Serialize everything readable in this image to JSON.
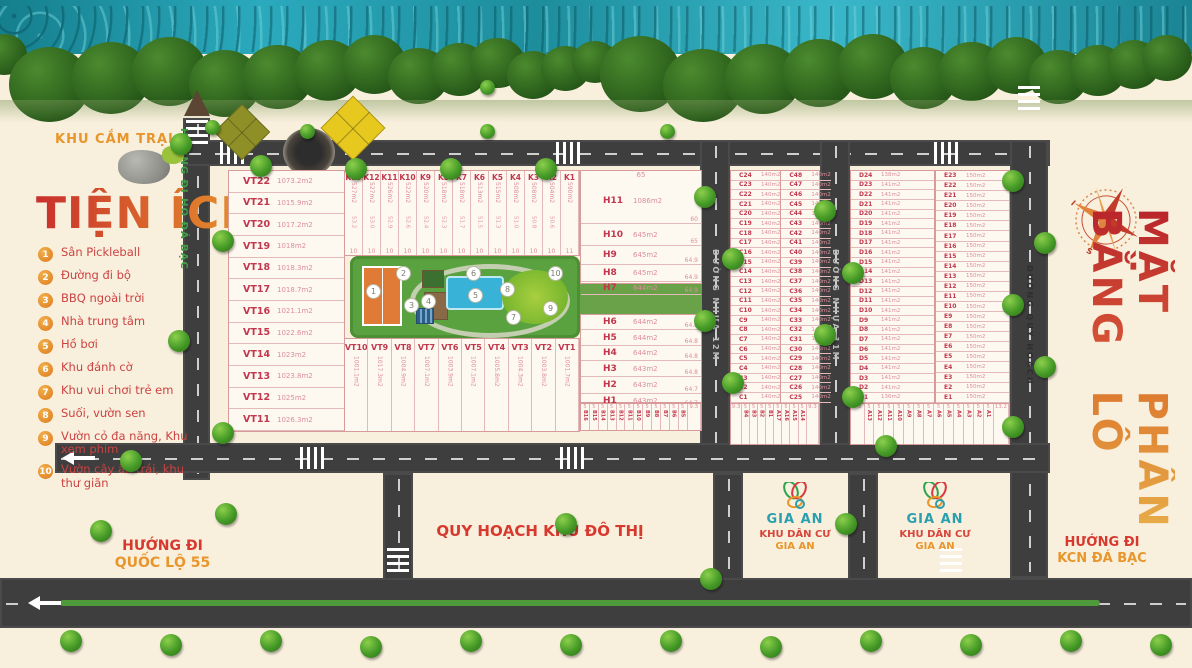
{
  "title": {
    "line1": "MẶT BẰNG",
    "line2": "PHÂN LÔ"
  },
  "compass": {
    "n": "N",
    "e": "E",
    "s": "S",
    "w": "W"
  },
  "legend": {
    "zone_label_red": "KHU CẮM",
    "zone_label_orange": "TRẠI",
    "title": "TIỆN ÍCH",
    "items": [
      {
        "num": "1",
        "label": "Sân Pickleball"
      },
      {
        "num": "2",
        "label": "Đường đi bộ"
      },
      {
        "num": "3",
        "label": "BBQ ngoài trời"
      },
      {
        "num": "4",
        "label": "Nhà trung tâm"
      },
      {
        "num": "5",
        "label": "Hồ bơi"
      },
      {
        "num": "6",
        "label": "Khu đánh cờ"
      },
      {
        "num": "7",
        "label": "Khu vui chơi trẻ em"
      },
      {
        "num": "8",
        "label": "Suối, vườn sen"
      },
      {
        "num": "9",
        "label": "Vườn cỏ đa năng, Khu xem phim"
      },
      {
        "num": "10",
        "label": "Vườn cây ăn trái, khu thư giãn"
      }
    ]
  },
  "roads": {
    "left_vertical": "HƯỚNG ĐI HỒ ĐÁ BẠC",
    "nhua12": "ĐƯỜNG NHỰA 12M",
    "nhua11": "ĐƯỜNG NHỰA 11M",
    "quyhoach": "ĐƯỜNG QUY HOẠCH",
    "bottom_center": "QUY HOẠCH KHU ĐÔ THỊ",
    "bottom_left_1": "HƯỚNG ĐI",
    "bottom_left_2": "QUỐC LỘ 55",
    "bottom_right_1": "HƯỚNG ĐI",
    "bottom_right_2": "KCN ĐÁ BẠC"
  },
  "gia_an": {
    "logo_text": "GIA AN",
    "line1": "KHU DÂN CƯ",
    "line2": "GIA AN"
  },
  "blocks": {
    "vt_left": [
      {
        "id": "VT22",
        "area": "1073.2m2"
      },
      {
        "id": "VT21",
        "area": "1015.9m2"
      },
      {
        "id": "VT20",
        "area": "1017.2m2"
      },
      {
        "id": "VT19",
        "area": "1018m2"
      },
      {
        "id": "VT18",
        "area": "1018.3m2"
      },
      {
        "id": "VT17",
        "area": "1018.7m2"
      },
      {
        "id": "VT16",
        "area": "1021.1m2"
      },
      {
        "id": "VT15",
        "area": "1022.6m2"
      },
      {
        "id": "VT14",
        "area": "1023m2"
      },
      {
        "id": "VT13",
        "area": "1023.8m2"
      },
      {
        "id": "VT12",
        "area": "1025m2"
      },
      {
        "id": "VT11",
        "area": "1026.3m2"
      }
    ],
    "k_row": [
      {
        "id": "K13",
        "area": "527m2",
        "dim": "53.2",
        "w": "10"
      },
      {
        "id": "K12",
        "area": "527m2",
        "dim": "53.0",
        "w": "10"
      },
      {
        "id": "K11",
        "area": "526m2",
        "dim": "52.9",
        "w": "10"
      },
      {
        "id": "K10",
        "area": "522m2",
        "dim": "52.6",
        "w": "10"
      },
      {
        "id": "K9",
        "area": "520m2",
        "dim": "52.4",
        "w": "10"
      },
      {
        "id": "K8",
        "area": "518m2",
        "dim": "52.3",
        "w": "10"
      },
      {
        "id": "K7",
        "area": "518m2",
        "dim": "51.7",
        "w": "10"
      },
      {
        "id": "K6",
        "area": "513m2",
        "dim": "51.5",
        "w": "10"
      },
      {
        "id": "K5",
        "area": "515m2",
        "dim": "51.3",
        "w": "10"
      },
      {
        "id": "K4",
        "area": "508m2",
        "dim": "51.0",
        "w": "10"
      },
      {
        "id": "K3",
        "area": "508m2",
        "dim": "50.8",
        "w": "10"
      },
      {
        "id": "K2",
        "area": "504m2",
        "dim": "50.6",
        "w": "10"
      },
      {
        "id": "K1",
        "area": "590m2",
        "dim": "",
        "w": "11"
      }
    ],
    "vt_bottom": [
      {
        "id": "VT10",
        "area": "1001.1m2"
      },
      {
        "id": "VT9",
        "area": "1017.3m2"
      },
      {
        "id": "VT8",
        "area": "1004.9m2"
      },
      {
        "id": "VT7",
        "area": "1007.1m2"
      },
      {
        "id": "VT6",
        "area": "1003.9m2"
      },
      {
        "id": "VT5",
        "area": "1007.1m2"
      },
      {
        "id": "VT4",
        "area": "1005.8m2"
      },
      {
        "id": "VT3",
        "area": "1004.3m2"
      },
      {
        "id": "VT2",
        "area": "1003.8m2"
      },
      {
        "id": "VT1",
        "area": "1001.7m2"
      }
    ],
    "h_top_dim": "65",
    "h_col_upper": [
      {
        "id": "H11",
        "area": "1086m2",
        "dim": "60",
        "h": 45
      },
      {
        "id": "H10",
        "area": "645m2",
        "dim": "65",
        "h": 22
      },
      {
        "id": "H9",
        "area": "645m2",
        "dim": "64.9",
        "h": 19
      },
      {
        "id": "H8",
        "area": "645m2",
        "dim": "64.9",
        "h": 17
      },
      {
        "id": "H7",
        "area": "644m2",
        "dim": "64.9",
        "h": 13
      }
    ],
    "h_col_lower": [
      {
        "id": "H6",
        "area": "644m2",
        "dim": "64.8",
        "h": 15
      },
      {
        "id": "H5",
        "area": "644m2",
        "dim": "64.8",
        "h": 16
      },
      {
        "id": "H4",
        "area": "644m2",
        "dim": "64.8",
        "h": 15
      },
      {
        "id": "H3",
        "area": "643m2",
        "dim": "64.8",
        "h": 16
      },
      {
        "id": "H2",
        "area": "643m2",
        "dim": "64.7",
        "h": 17
      },
      {
        "id": "H1",
        "area": "643m2",
        "dim": "64.7",
        "h": 14
      }
    ],
    "c_area": "140m2",
    "d_area": "141m2",
    "e_area": "150m2",
    "c_left_start": 24,
    "c_right_start": 48,
    "d_start": 24,
    "e_start": 23,
    "d_first_area": "138m2",
    "d_last_area": "136m2",
    "small_h": [
      "B16",
      "B15",
      "B14",
      "B13",
      "B12",
      "B11",
      "B10",
      "B9",
      "B8",
      "B7",
      "B6",
      "B5"
    ],
    "small_h_w": "5",
    "small_c": [
      "B4",
      "B3",
      "B2",
      "B1",
      "A17",
      "A16",
      "A15",
      "A14"
    ],
    "small_c_end": "9.3",
    "small_de": [
      "A13",
      "A12",
      "A11",
      "A10",
      "A9",
      "A8",
      "A7",
      "A6",
      "A5",
      "A4",
      "A3",
      "A2",
      "A1"
    ],
    "small_de_start": "8.2",
    "small_de_end": "13.2"
  }
}
